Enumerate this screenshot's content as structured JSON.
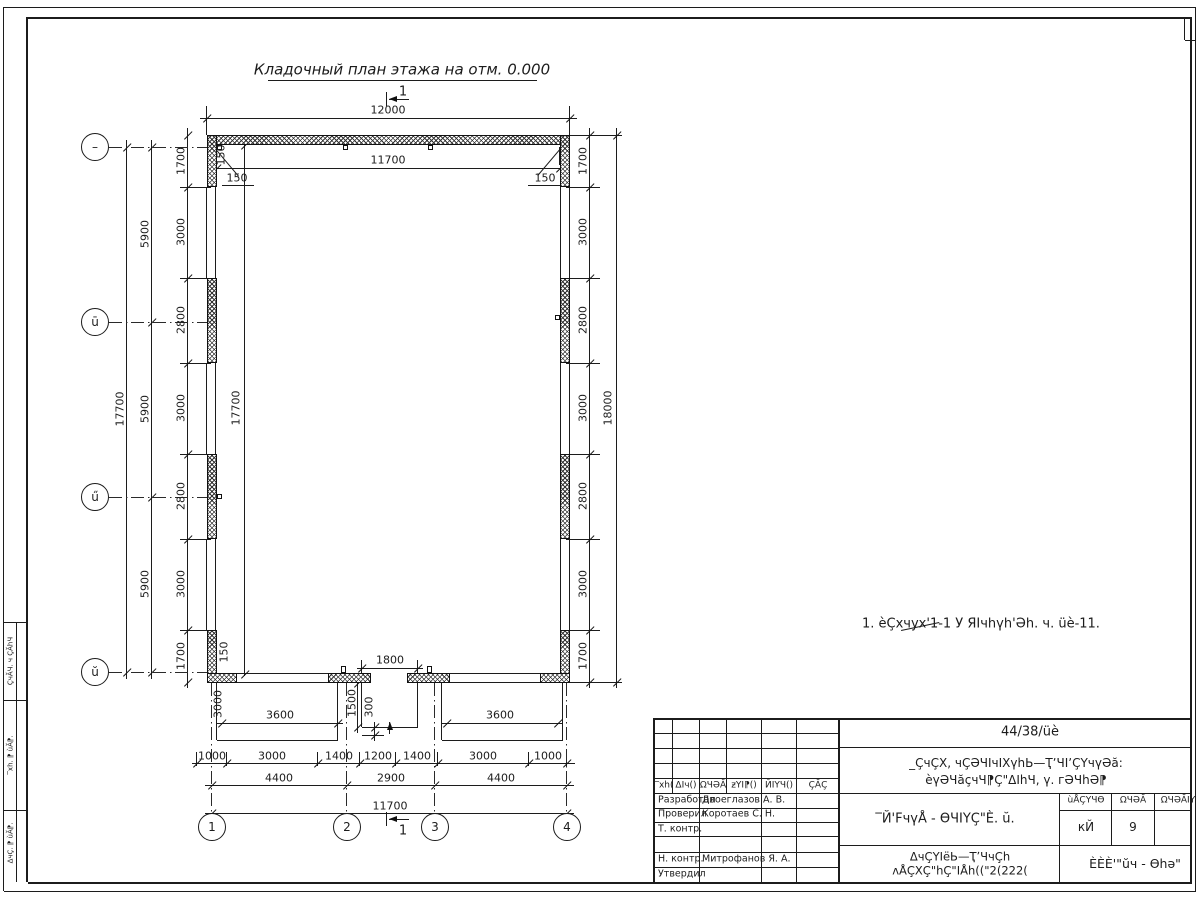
{
  "page_title": "Кладочный план этажа на отм. 0.000",
  "note": "1. èÇхчух'1-1 У ЯIчhүh'Әh. ч. üè-11.",
  "section_label": "1",
  "axes": {
    "left": [
      "–",
      "ū",
      "ű",
      "ŭ"
    ],
    "bottom": [
      "1",
      "2",
      "3",
      "4"
    ]
  },
  "dims": {
    "d12000": "12000",
    "d11700": "11700",
    "d150": "150",
    "d17700": "17700",
    "d18000": "18000",
    "d5900": "5900",
    "d1800": "1800",
    "d3600": "3600",
    "d1500": "1500",
    "d300": "300",
    "d3000": "3000",
    "left_col": [
      "1700",
      "3000",
      "2800",
      "3000",
      "2800",
      "3000",
      "1700"
    ],
    "right_col": [
      "1700",
      "3000",
      "2800",
      "3000",
      "2800",
      "3000",
      "1700"
    ],
    "bottom_row1": [
      "1000",
      "3000",
      "1400",
      "1200",
      "1400",
      "3000",
      "1000"
    ],
    "bottom_row2": [
      "4400",
      "2900",
      "4400"
    ],
    "bottom_row3": "11700"
  },
  "titleblock": {
    "doc_number": "44/38/üè",
    "project_line1": "_ÇчÇХ, чÇӘЧIчIХүhЬ—ҬʼЧIʼÇҮчүӘă:",
    "project_line2": "èүӘЧăçчЧ⁋Ç\"ΔIhЧ, ү. гӘЧhӘ⁋",
    "drawing_title": "‾Й'FчүÅ - ѲЧIҮÇ\"È. ŭ.",
    "org_line1": "ΔчÇҮIёЬ—ҬʼЧчÇh",
    "org_line2": "ʌÅÇХÇ\"hÇ\"IÅh((\"2(222(",
    "org_code": "ÈÈÈ'\"ŭч - Ѳhә\"",
    "header_cols": [
      "‾хh(",
      "ΔIч()",
      "ΩЧӘĂ",
      "ƶҮI⁋()",
      "ЙIҮЧ()",
      "ÇĂÇ"
    ],
    "stage_table": {
      "headers": [
        "ùÅÇҮЧѲ",
        "ΩЧӘĂ",
        "ΩЧӘĂIҮ"
      ],
      "values": [
        "кЙ",
        "9",
        ""
      ]
    },
    "sign_rows": [
      {
        "role": "Разработал",
        "name": "Двоеглазов А. В."
      },
      {
        "role": "Проверил",
        "name": "Коротаев С. Н."
      },
      {
        "role": "Т. контр.",
        "name": ""
      },
      {
        "role": "",
        "name": ""
      },
      {
        "role": "Н. контр.",
        "name": "Митрофанов Я. А."
      },
      {
        "role": "Утвердил",
        "name": ""
      }
    ],
    "margin_labels": [
      "ÇчĂЧ. ч ÇĂhЧ",
      "‾хh. ⁋ ùĂ⁋.",
      "ΔчÇ. ⁋ ùĂ⁋."
    ]
  }
}
